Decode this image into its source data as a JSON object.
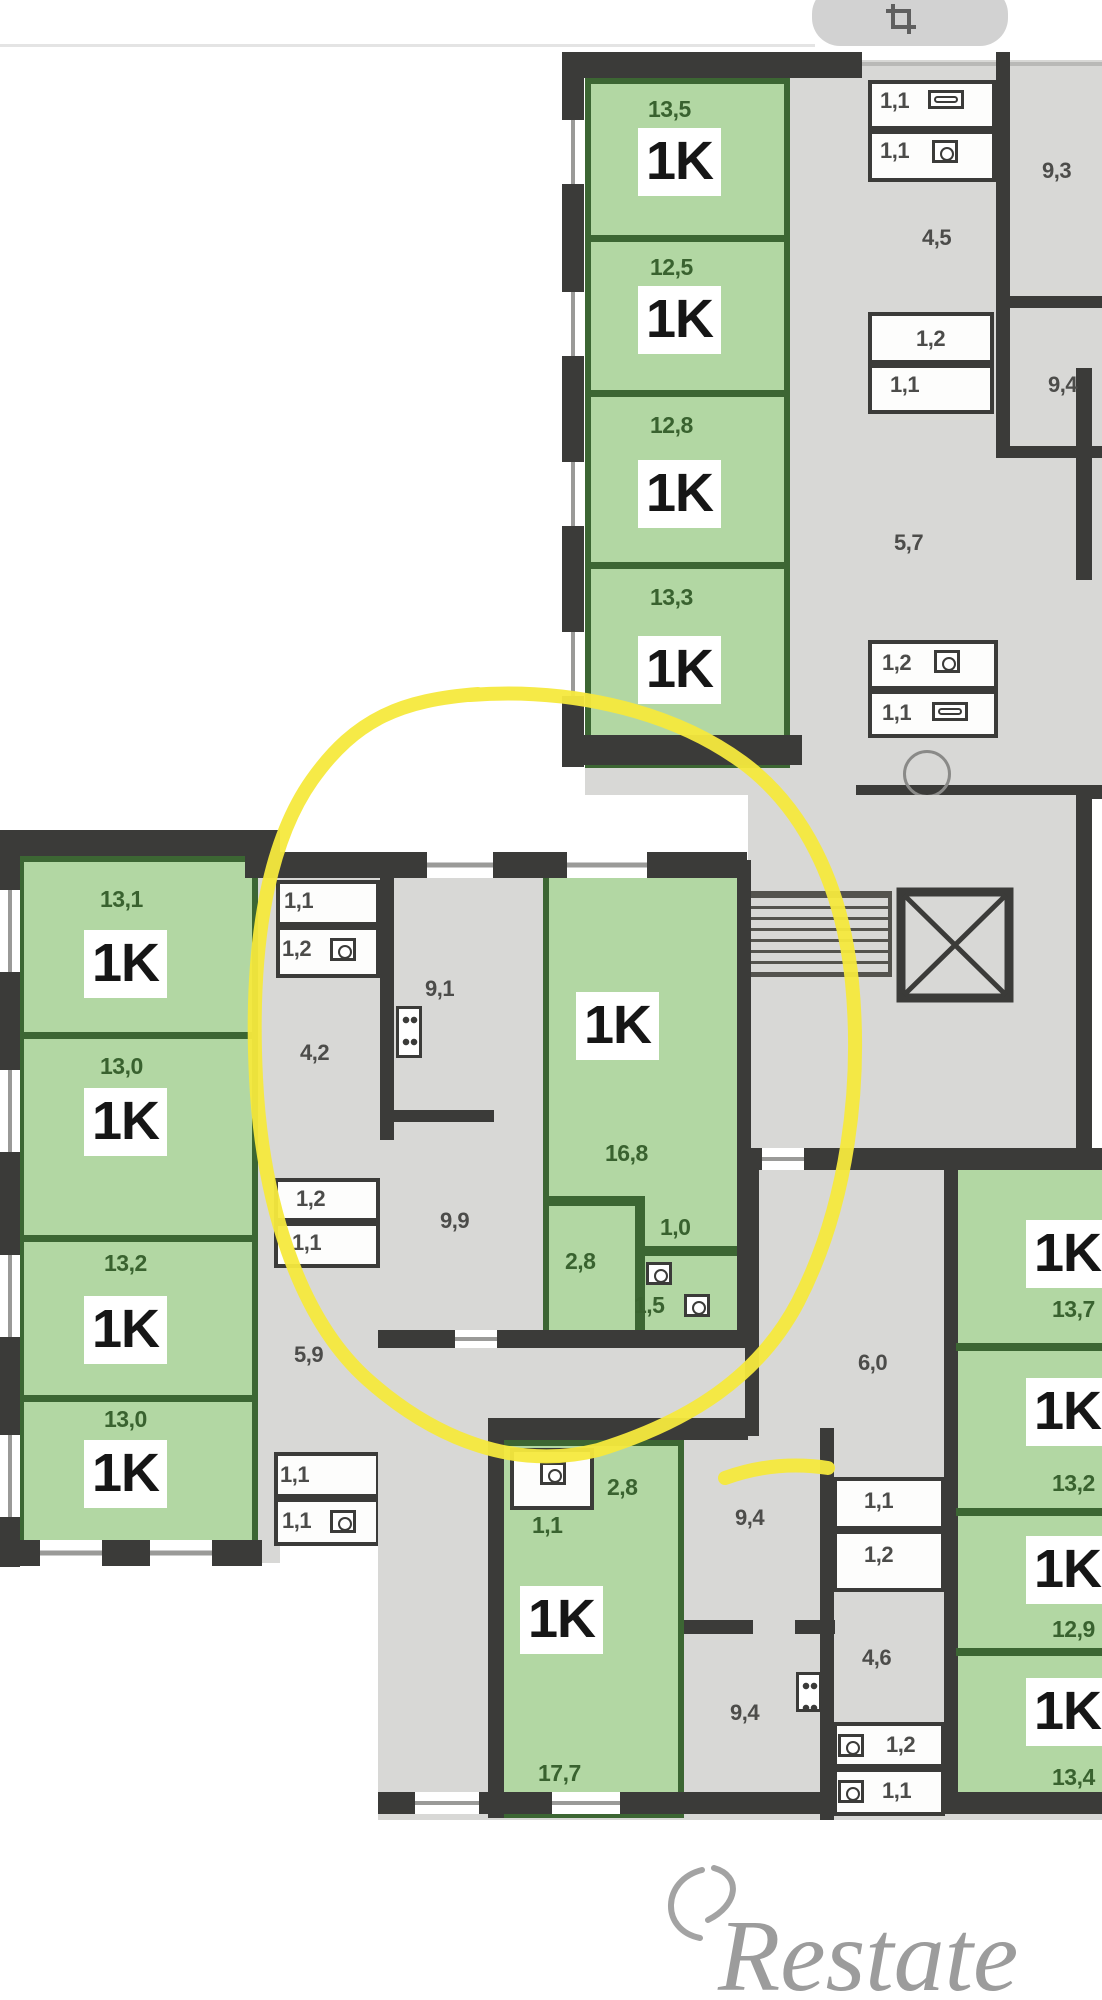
{
  "ui": {
    "crop_button_icon": "crop-icon"
  },
  "plan": {
    "top_right_building": {
      "apartments": [
        {
          "type": "1K",
          "area": "13,5"
        },
        {
          "type": "1K",
          "area": "12,5"
        },
        {
          "type": "1K",
          "area": "12,8"
        },
        {
          "type": "1K",
          "area": "13,3"
        }
      ],
      "service_rooms": {
        "wc_a": "1,1",
        "wc_b": "1,1",
        "hall_a": "4,5",
        "room_a": "9,3",
        "wc_c": "1,2",
        "wc_d": "1,1",
        "room_b": "9,4",
        "hall_b": "5,7",
        "wc_e": "1,2",
        "wc_f": "1,1"
      }
    },
    "left_building": {
      "apartments": [
        {
          "type": "1K",
          "area": "13,1"
        },
        {
          "type": "1K",
          "area": "13,0"
        },
        {
          "type": "1K",
          "area": "13,2"
        },
        {
          "type": "1K",
          "area": "13,0"
        }
      ],
      "service_rooms": {
        "wc_a": "1,1",
        "wc_b": "1,2",
        "hall_a": "4,2",
        "wc_c": "1,2",
        "wc_d": "1,1",
        "hall_b": "5,9",
        "wc_e": "1,1",
        "wc_f": "1,1"
      }
    },
    "highlighted_apartment": {
      "type": "1K",
      "room": "16,8",
      "kitchen": "9,1",
      "corridor": "9,9",
      "entry": "2,8",
      "wc": "1,0",
      "bath": "1,5"
    },
    "bottom_building": {
      "left_apartment": {
        "type": "1K",
        "room": "17,7",
        "entry": "2,8",
        "wc": "1,1"
      },
      "right_apartments": [
        {
          "type": "1K",
          "area": "13,7"
        },
        {
          "type": "1K",
          "area": "13,2"
        },
        {
          "type": "1K",
          "area": "12,9"
        },
        {
          "type": "1K",
          "area": "13,4"
        }
      ],
      "service_rooms": {
        "hall_top": "6,0",
        "wc_a": "1,1",
        "wc_b": "1,2",
        "kitchen_a": "9,4",
        "hall_mid": "4,6",
        "kitchen_b": "9,4",
        "wc_c": "1,2",
        "wc_d": "1,1"
      }
    }
  },
  "watermark": {
    "brand": "Restate"
  }
}
